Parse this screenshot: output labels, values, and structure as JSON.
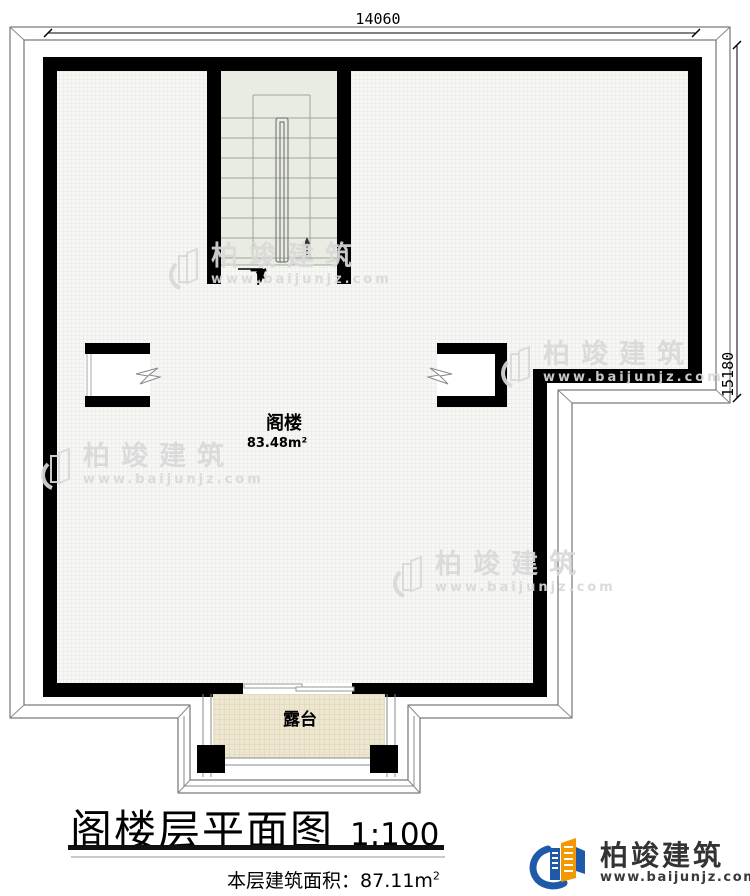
{
  "plan": {
    "dimensions": {
      "top": "14060",
      "right": "15180"
    },
    "stair": {
      "down_label": "下"
    },
    "attic": {
      "name": "阁楼",
      "area": "83.48m²"
    },
    "terrace": {
      "name": "露台"
    }
  },
  "title_block": {
    "title": "阁楼层平面图",
    "scale": "1:100",
    "area_label": "本层建筑面积：",
    "area_value": "87.11m",
    "area_sup": "2"
  },
  "watermark": {
    "brand": "柏竣建筑",
    "url": "www.baijunjz.com"
  },
  "logo": {
    "brand": "柏竣建筑",
    "url": "www.baijunjz.com"
  },
  "colors": {
    "wall": "#000000",
    "floor_fill": "#f7f7f5",
    "stair_fill": "#e9ece3",
    "terrace_fill": "#ede7d1",
    "roof_line": "#5a5a5a",
    "logo_blue": "#1f5aa8",
    "logo_orange": "#f39800",
    "watermark_gray": "#d9d9d9"
  }
}
